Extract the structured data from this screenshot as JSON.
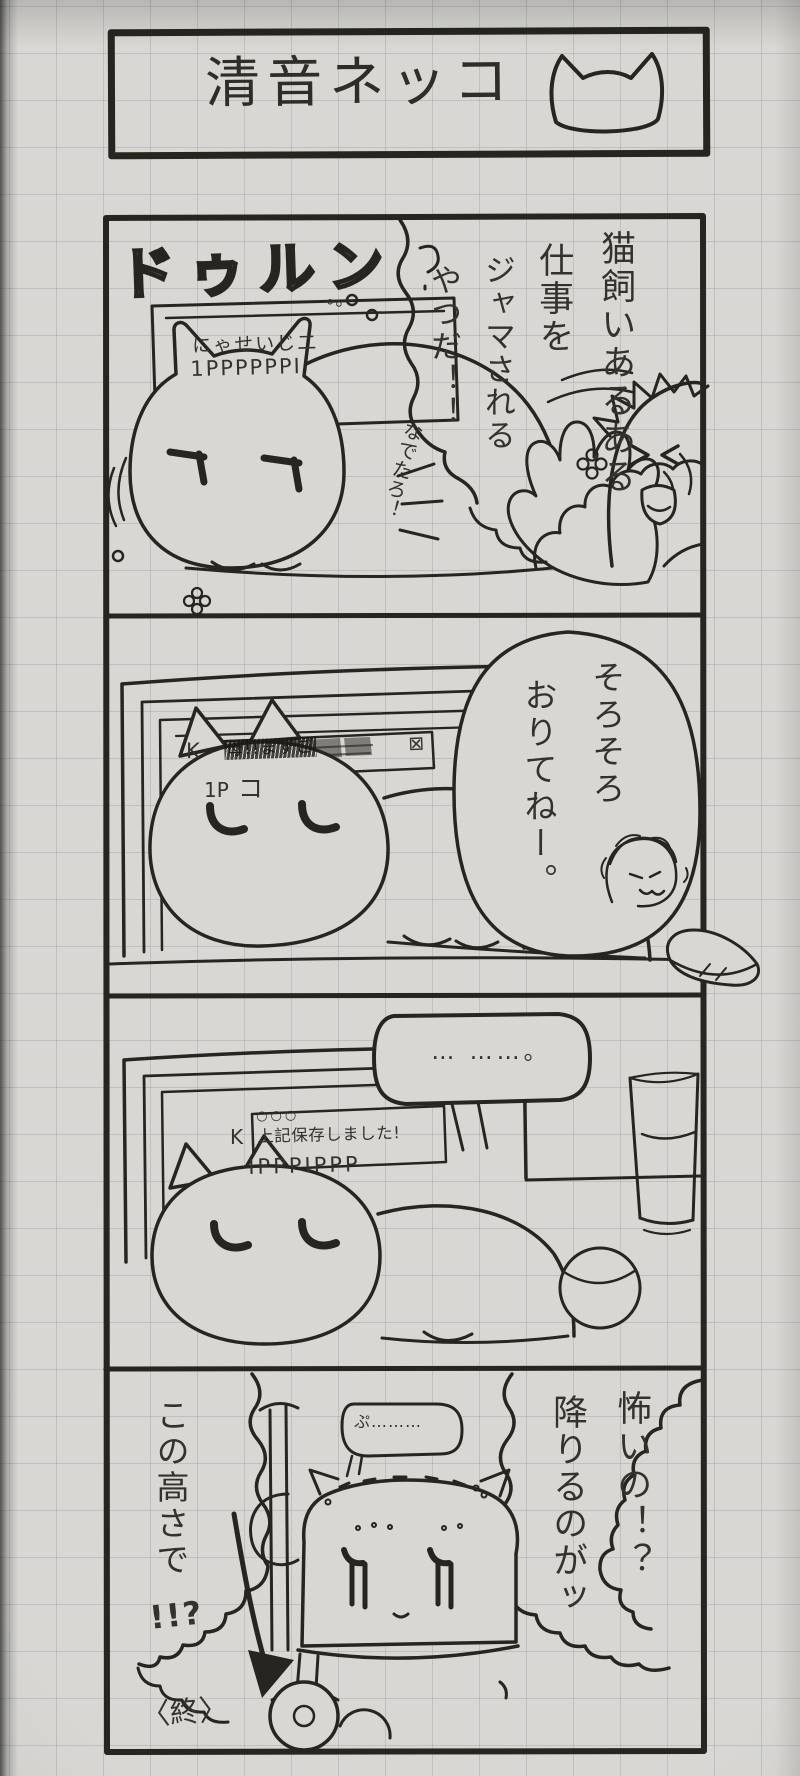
{
  "colors": {
    "ink": "#26251f",
    "paper": "#d8d7d3",
    "pen_text": "#33322c"
  },
  "title": {
    "text": "清音ネッコ",
    "icon": "cat-face"
  },
  "panel1": {
    "narration": [
      "猫飼いあるある",
      "仕事を",
      "ジャマされる",
      "やつだ！！"
    ],
    "aside": "なでたろ！",
    "sfx": "ドゥルン",
    "sfx_trail": "。。",
    "screen_line1": "にゃせいじ二",
    "screen_line2": "1PPPPPPI"
  },
  "panel2": {
    "speech": [
      "そろそろ",
      "おりてねー。"
    ],
    "screen_prefix": "K",
    "screen_scribble": "母!!まずご",
    "screen_close": "⊠",
    "screen_line2a": "1P",
    "screen_line2b": "コ"
  },
  "panel3": {
    "speech": "… ……。",
    "window_dots": "○○○",
    "screen_prefix": "K",
    "screen_text": "上記保存しました!",
    "keyboard_text": "IPPPIPPP"
  },
  "panel4": {
    "fear": [
      "怖いの！？",
      "降りるのがッ"
    ],
    "height_text": "この高さで",
    "height_excl": "!!?",
    "mutter": "ぷ………",
    "end_mark": "〈終〉"
  }
}
